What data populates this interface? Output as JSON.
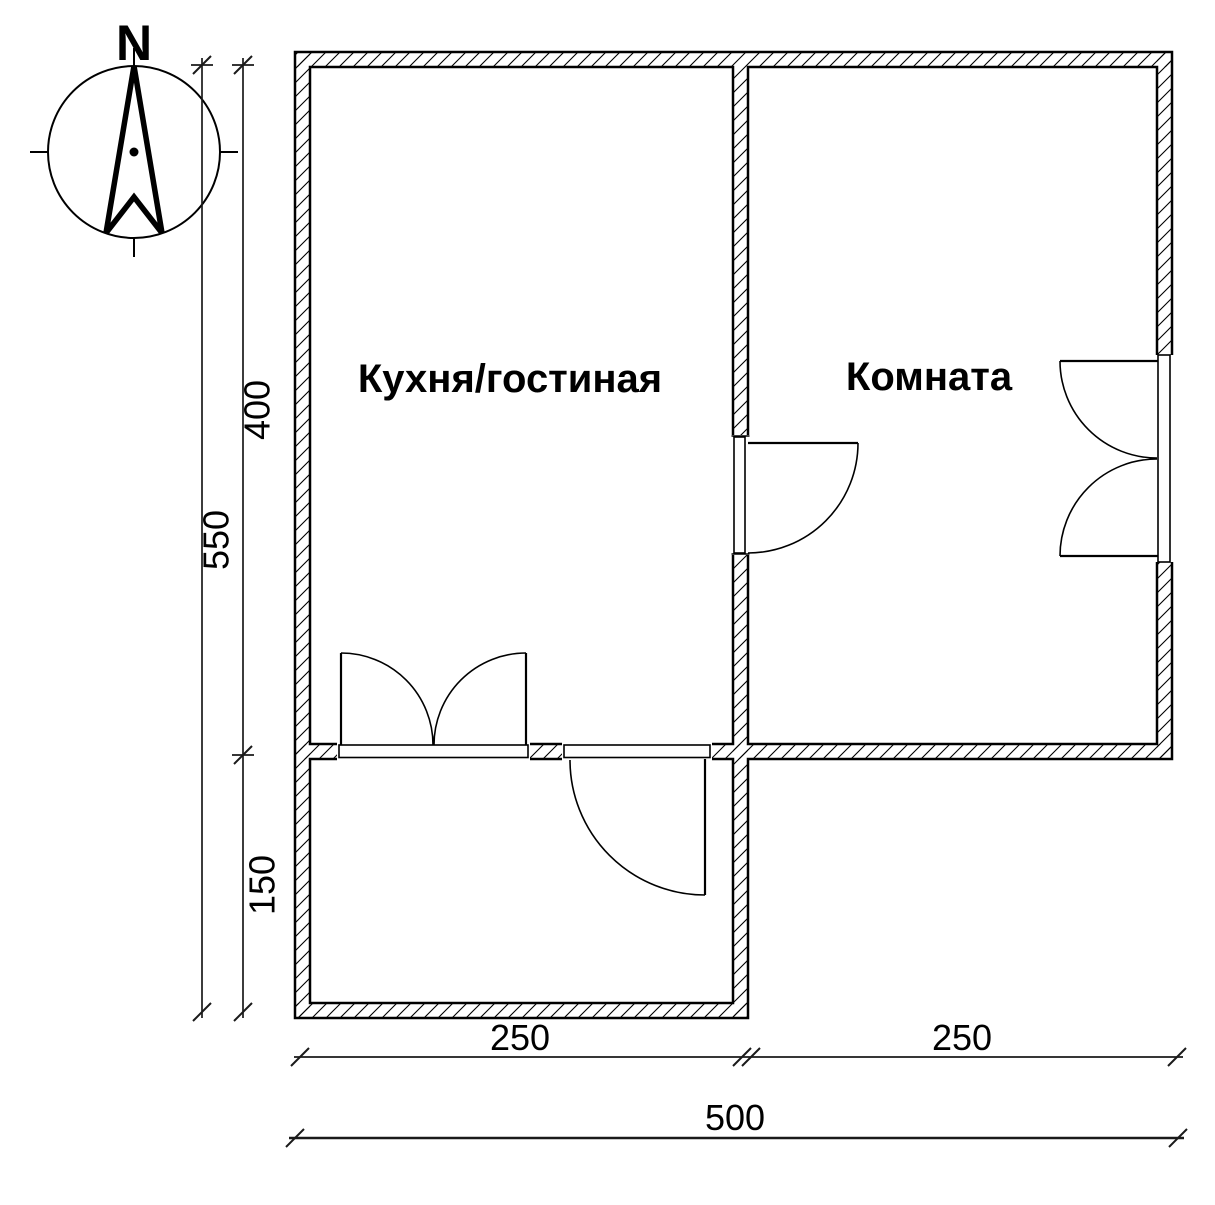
{
  "plan_title": "floor-plan",
  "compass": {
    "north_label": "N"
  },
  "rooms": [
    {
      "id": "kitchen-living",
      "label": "Кухня/гостиная"
    },
    {
      "id": "room",
      "label": "Комната"
    }
  ],
  "dims": {
    "v400": "400",
    "v550": "550",
    "v150": "150",
    "h250l": "250",
    "h250r": "250",
    "h500": "500"
  },
  "colors": {
    "line": "#000000",
    "background": "#ffffff"
  }
}
